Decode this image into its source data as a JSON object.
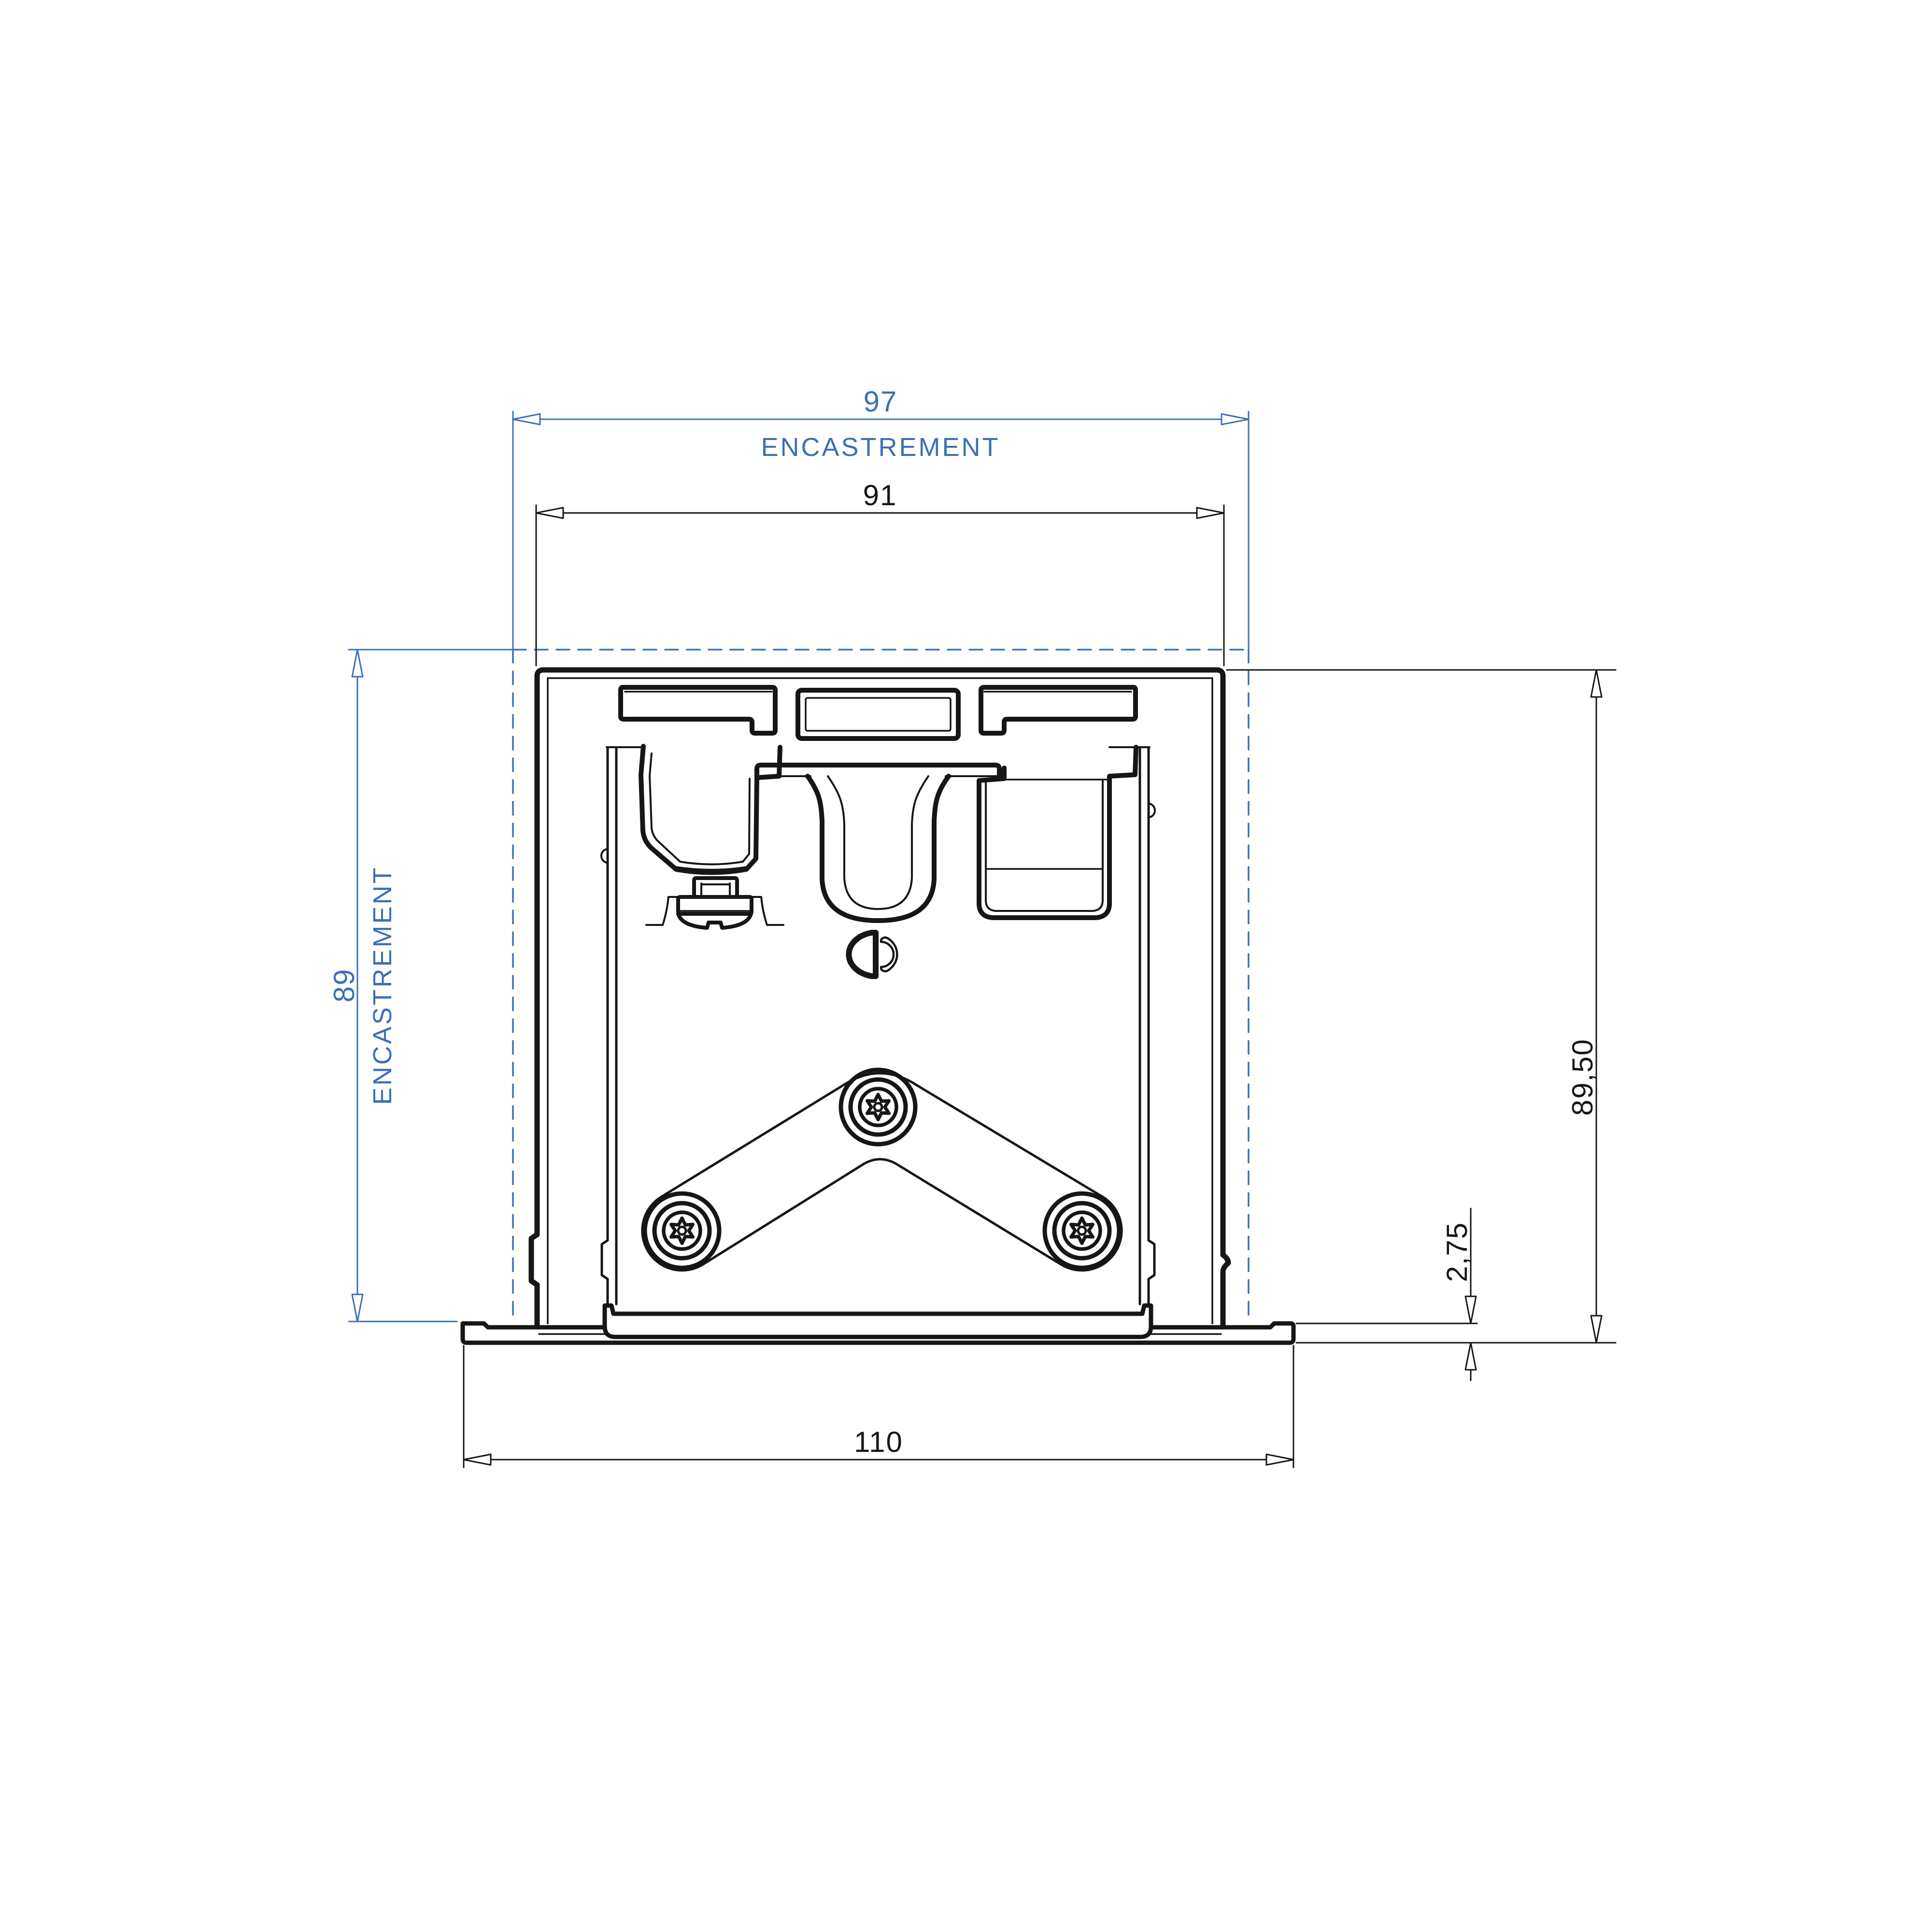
{
  "drawing_title": "recessed-profile-cross-section",
  "dimensions": {
    "recess_width": {
      "value": "97",
      "label": "ENCASTREMENT"
    },
    "profile_width": {
      "value": "91"
    },
    "recess_depth": {
      "value": "89",
      "label": "ENCASTREMENT"
    },
    "overall_height": {
      "value": "89,50"
    },
    "flange_thickness": {
      "value": "2,75"
    },
    "overall_width": {
      "value": "110"
    }
  },
  "colors": {
    "dimension_blue": "#3b70b5",
    "line_black": "#161616",
    "background": "#ffffff"
  },
  "icons": {
    "screw_type": "torx-screw-icon",
    "screw_count": "3"
  }
}
